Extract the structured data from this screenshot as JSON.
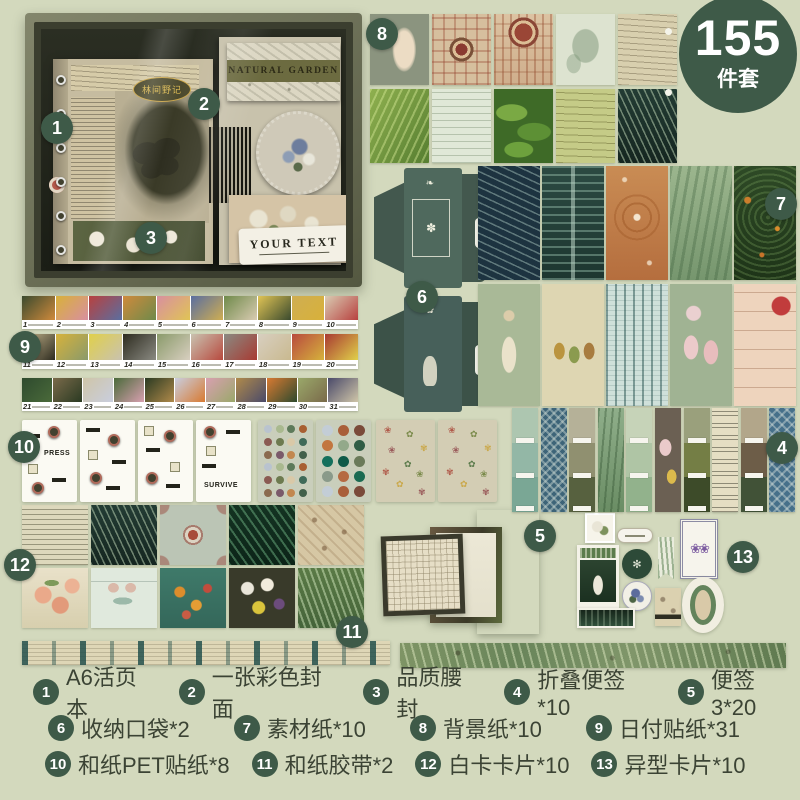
{
  "colors": {
    "background": "#d3d9bd",
    "badge": "#3e5a48",
    "legend_text": "#3b4334"
  },
  "badge": {
    "count": "155",
    "unit": "件套"
  },
  "box_photo": {
    "notebook_label": "林间野记",
    "paper_title": "NATURAL GARDEN",
    "ticket_text": "YOUR TEXT"
  },
  "sticker_sheets": {
    "labels": [
      "PRESS",
      "SURVIVE"
    ]
  },
  "date_stickers": {
    "strips": [
      {
        "days": [
          "1",
          "2",
          "3",
          "4",
          "5",
          "6",
          "7",
          "8",
          "9",
          "10"
        ]
      },
      {
        "days": [
          "11",
          "12",
          "13",
          "14",
          "15",
          "16",
          "17",
          "18",
          "19",
          "20"
        ]
      },
      {
        "days": [
          "21",
          "22",
          "23",
          "24",
          "25",
          "26",
          "27",
          "28",
          "29",
          "30",
          "31"
        ]
      }
    ]
  },
  "markers": [
    "1",
    "2",
    "3",
    "4",
    "5",
    "6",
    "7",
    "8",
    "9",
    "10",
    "11",
    "12",
    "13"
  ],
  "legend": {
    "rows": [
      [
        {
          "num": "1",
          "label": "A6活页本"
        },
        {
          "num": "2",
          "label": "一张彩色封面"
        },
        {
          "num": "3",
          "label": "品质腰封"
        },
        {
          "num": "4",
          "label": "折叠便签*10"
        },
        {
          "num": "5",
          "label": "便签3*20"
        }
      ],
      [
        {
          "num": "6",
          "label": "收纳口袋*2"
        },
        {
          "num": "7",
          "label": "素材纸*10"
        },
        {
          "num": "8",
          "label": "背景纸*10"
        },
        {
          "num": "9",
          "label": "日付贴纸*31"
        }
      ],
      [
        {
          "num": "10",
          "label": "和纸PET贴纸*8"
        },
        {
          "num": "11",
          "label": "和纸胶带*2"
        },
        {
          "num": "12",
          "label": "白卡卡片*10"
        },
        {
          "num": "13",
          "label": "异型卡片*10"
        }
      ]
    ]
  }
}
